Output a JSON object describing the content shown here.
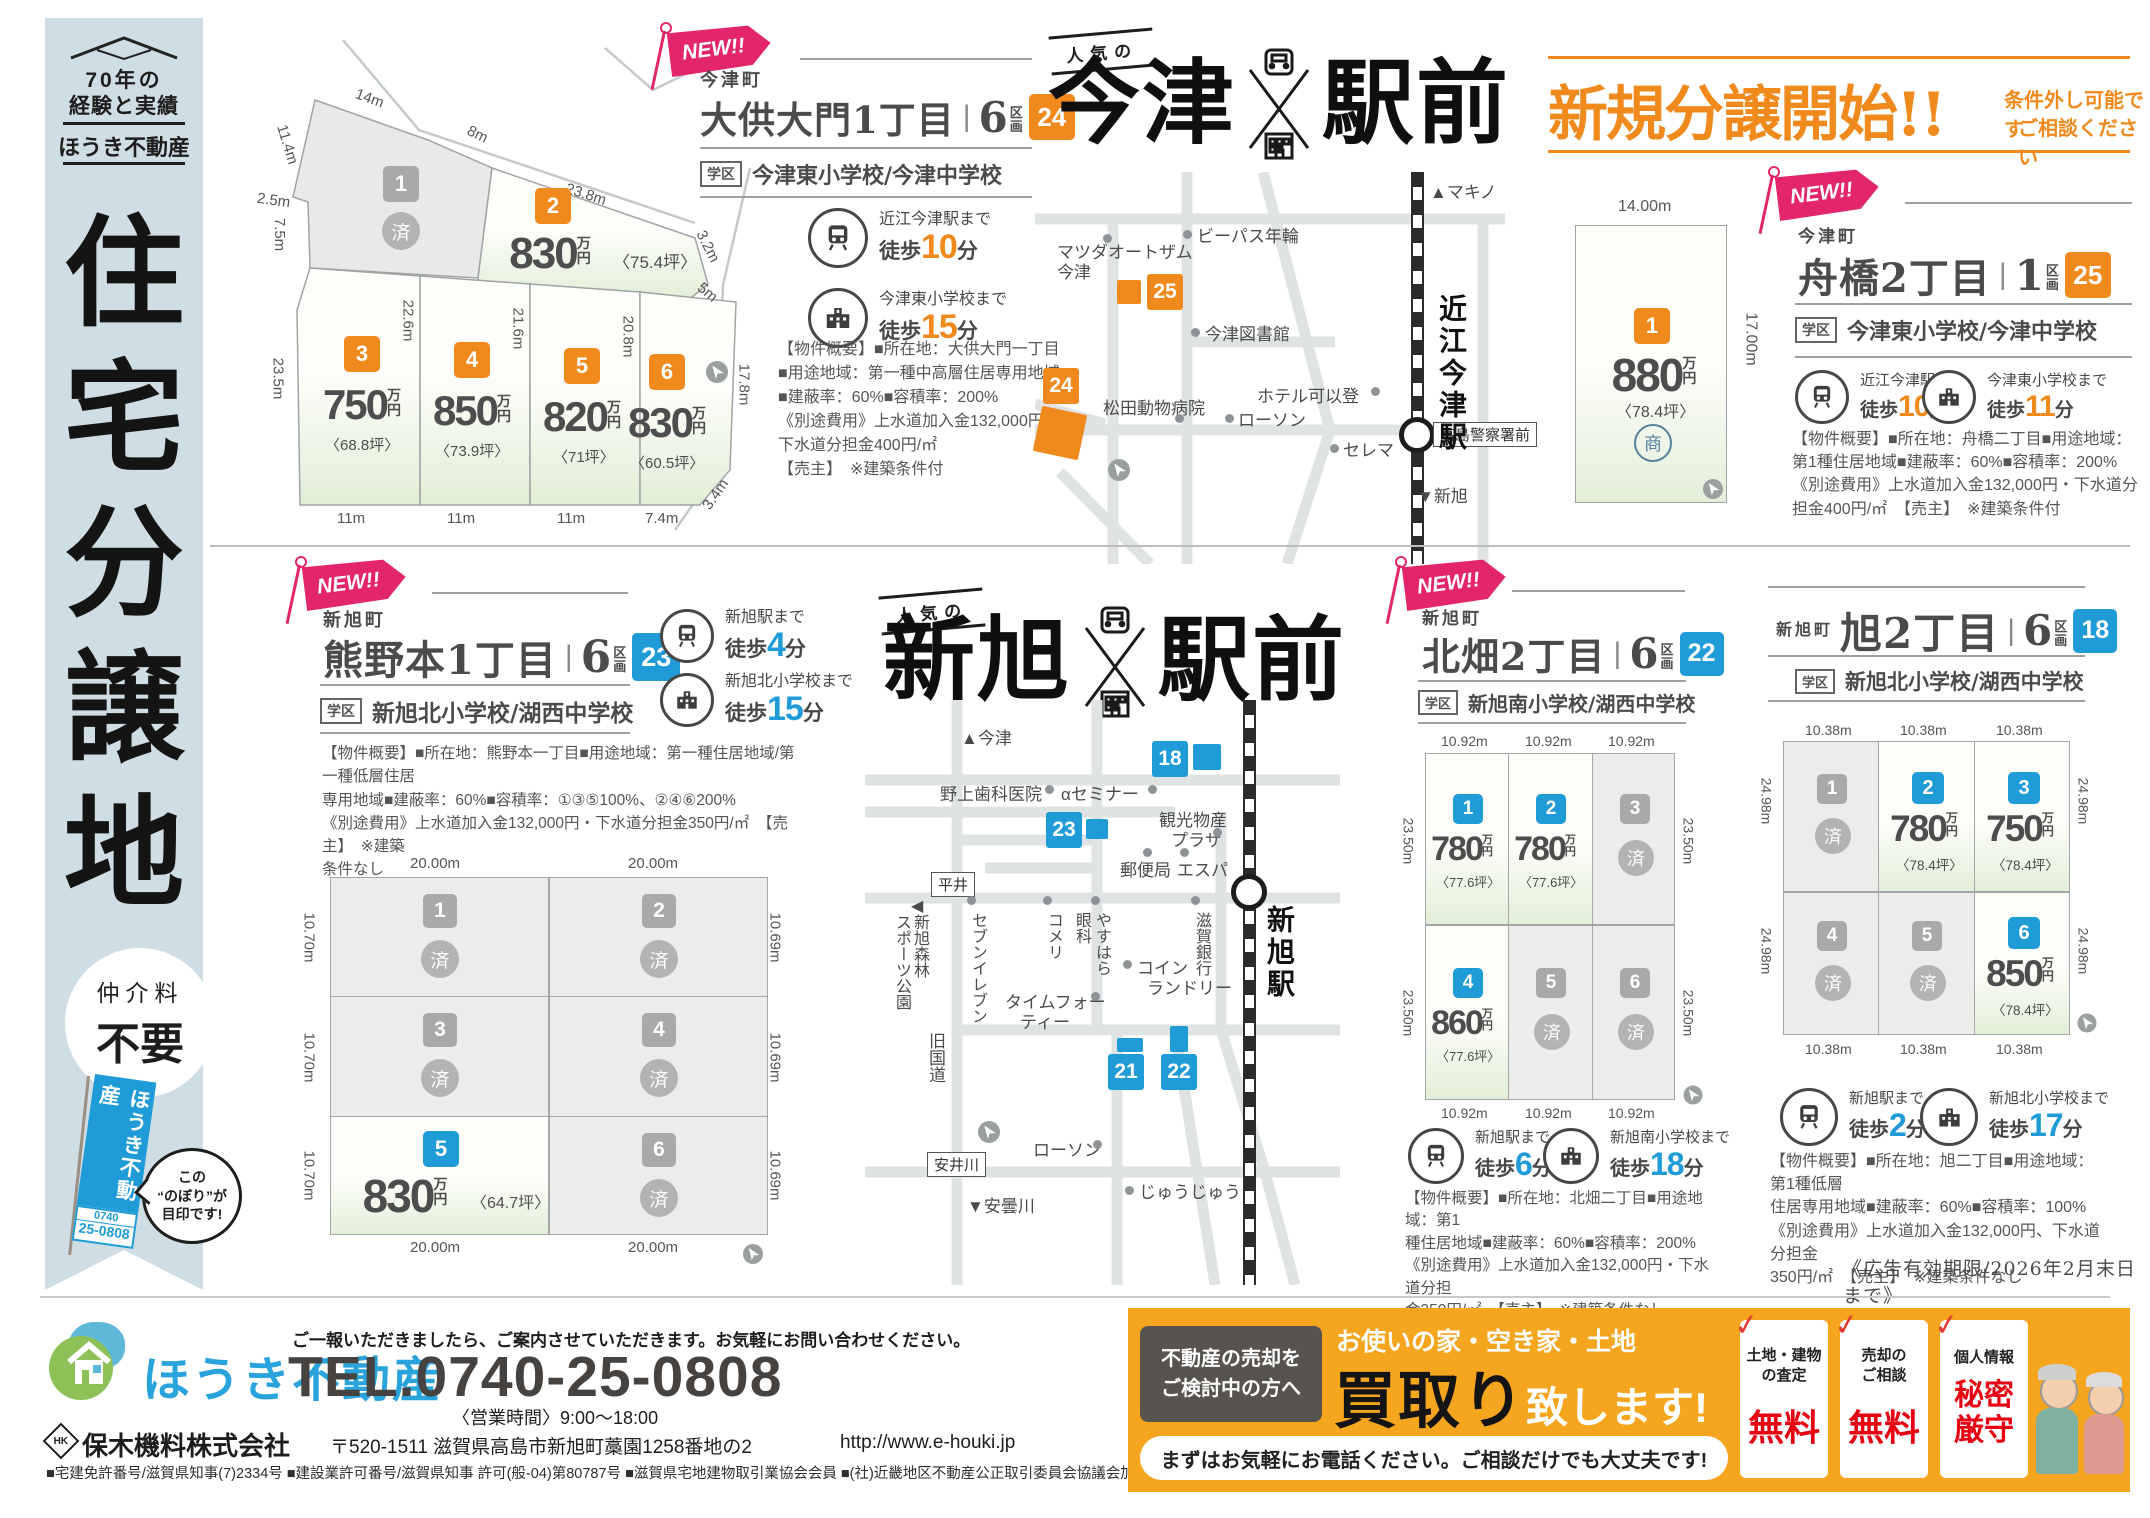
{
  "colors": {
    "orange": "#f08a1d",
    "blue": "#1f9cd8",
    "pink": "#e3256c",
    "footer_blue": "#29a3dc",
    "kaitori_orange": "#f6a51f",
    "check_red": "#e23a2e",
    "sidebar_bg": "#cfdde4"
  },
  "common": {
    "new": "NEW!!",
    "gakku": "学区",
    "sold": "済",
    "walk": "徒歩",
    "minute": "分",
    "man": "万",
    "yen": "円",
    "ku": "区",
    "kaku": "画",
    "popular": "人気の",
    "sho": "商"
  },
  "sidebar": {
    "roof_tag1": "70年の",
    "roof_tag2": "経験と実績",
    "brand": "ほうき不動産",
    "title_chars": [
      "住",
      "宅",
      "分",
      "譲",
      "地"
    ],
    "fee1": "仲介料",
    "fee2": "不要",
    "flag_text": "ほうき不動産",
    "flag_tel1": "0740",
    "flag_tel2": "25-0808",
    "bubble1": "この",
    "bubble2": "“のぼり”が",
    "bubble3": "目印です!"
  },
  "banner": {
    "title": "新規分譲開始!!",
    "note1": "条件外し可能です",
    "note2": "ご相談ください"
  },
  "titles": {
    "imazu_left": "今津",
    "imazu_right": "駅前",
    "shin_left": "新旭",
    "shin_right": "駅前"
  },
  "panels": {
    "odai": {
      "town": "今津町",
      "name": "大供大門1丁目",
      "lots": "6",
      "badge": "24",
      "school": "今津東小学校/今津中学校",
      "acc1_dest": "近江今津駅まで",
      "acc1_min": "10",
      "acc2_dest": "今津東小学校まで",
      "acc2_min": "15",
      "ov": [
        "【物件概要】■所在地：大供大門一丁目",
        "■用途地域：第一種中高層住居専用地域",
        "■建蔽率：60%■容積率：200%",
        "《別途費用》上水道加入金132,000円・",
        "下水道分担金400円/㎡",
        "【売主】　※建築条件付"
      ]
    },
    "funabashi": {
      "town": "今津町",
      "name": "舟橋2丁目",
      "lots": "1",
      "badge": "25",
      "school": "今津東小学校/今津中学校",
      "acc1_dest": "近江今津駅まで",
      "acc1_min": "10",
      "acc2_dest": "今津東小学校まで",
      "acc2_min": "11",
      "ov": [
        "【物件概要】■所在地：舟橋二丁目■用途地域：",
        "第1種住居地域■建蔽率：60%■容積率：200%",
        "《別途費用》上水道加入金132,000円・下水道分",
        "担金400円/㎡　【売主】　※建築条件付"
      ]
    },
    "kumano": {
      "town": "新旭町",
      "name": "熊野本1丁目",
      "lots": "6",
      "badge": "23",
      "school": "新旭北小学校/湖西中学校",
      "acc1_dest": "新旭駅まで",
      "acc1_min": "4",
      "acc2_dest": "新旭北小学校まで",
      "acc2_min": "15",
      "ov": [
        "【物件概要】■所在地：熊野本一丁目■用途地域：第一種住居地域/第一種低層住居",
        "専用地域■建蔽率：60%■容積率：①③⑤100%、②④⑥200%",
        "《別途費用》上水道加入金132,000円・下水道分担金350円/㎡　【売主】　※建築",
        "条件なし"
      ]
    },
    "kitabata": {
      "town": "新旭町",
      "name": "北畑2丁目",
      "lots": "6",
      "badge": "22",
      "school": "新旭南小学校/湖西中学校",
      "acc1_dest": "新旭駅まで",
      "acc1_min": "6",
      "acc2_dest": "新旭南小学校まで",
      "acc2_min": "18",
      "ov": [
        "【物件概要】■所在地：北畑二丁目■用途地域：第1",
        "種住居地域■建蔽率：60%■容積率：200%",
        "《別途費用》上水道加入金132,000円・下水道分担",
        "金350円/㎡　【売主】　※建築条件なし"
      ]
    },
    "asahi": {
      "town": "新旭町",
      "name": "旭2丁目",
      "lots": "6",
      "badge": "18",
      "school": "新旭北小学校/湖西中学校",
      "acc1_dest": "新旭駅まで",
      "acc1_min": "2",
      "acc2_dest": "新旭北小学校まで",
      "acc2_min": "17",
      "ov": [
        "【物件概要】■所在地：旭二丁目■用途地域：第1種低層",
        "住居専用地域■建蔽率：60%■容積率：100%",
        "《別途費用》上水道加入金132,000円、下水道分担金",
        "350円/㎡　【売主】　※建築条件なし"
      ],
      "expiry": "《広告有効期限/2026年2月末日まで》"
    }
  },
  "plot_odai": {
    "dims": {
      "d14": "14m",
      "d8": "8m",
      "d238": "23.8m",
      "d114": "11.4m",
      "d25": "2.5m",
      "d75": "7.5m",
      "d32": "3.2m",
      "d5": "5m",
      "d235": "23.5m",
      "d226": "22.6m",
      "d216": "21.6m",
      "d208": "20.8m",
      "d178": "17.8m",
      "d34": "3.4m",
      "d11a": "11m",
      "d11b": "11m",
      "d11c": "11m",
      "d74": "7.4m"
    },
    "lot1": {
      "num": "1"
    },
    "lot2": {
      "num": "2",
      "price": "830",
      "tsubo": "〈75.4坪〉"
    },
    "lot3": {
      "num": "3",
      "price": "750",
      "tsubo": "〈68.8坪〉"
    },
    "lot4": {
      "num": "4",
      "price": "850",
      "tsubo": "〈73.9坪〉"
    },
    "lot5": {
      "num": "5",
      "price": "820",
      "tsubo": "〈71坪〉"
    },
    "lot6": {
      "num": "6",
      "price": "830",
      "tsubo": "〈60.5坪〉"
    }
  },
  "plot_funabashi": {
    "top": "14.00m",
    "right": "17.00m",
    "num": "1",
    "price": "880",
    "tsubo": "〈78.4坪〉"
  },
  "grid_kumano": {
    "top": [
      "20.00m",
      "20.00m"
    ],
    "left": "10.70m",
    "right": "10.69m",
    "bottom": [
      "20.00m",
      "20.00m"
    ],
    "c1": {
      "num": "1"
    },
    "c2": {
      "num": "2"
    },
    "c3": {
      "num": "3"
    },
    "c4": {
      "num": "4"
    },
    "c5": {
      "num": "5",
      "price": "830",
      "tsubo": "〈64.7坪〉"
    },
    "c6": {
      "num": "6"
    }
  },
  "grid_kitabata": {
    "top": [
      "10.92m",
      "10.92m",
      "10.92m"
    ],
    "side": "23.50m",
    "bottom": [
      "10.92m",
      "10.92m",
      "10.92m"
    ],
    "c1": {
      "num": "1",
      "price": "780",
      "tsubo": "〈77.6坪〉"
    },
    "c2": {
      "num": "2",
      "price": "780",
      "tsubo": "〈77.6坪〉"
    },
    "c3": {
      "num": "3"
    },
    "c4": {
      "num": "4",
      "price": "860",
      "tsubo": "〈77.6坪〉"
    },
    "c5": {
      "num": "5"
    },
    "c6": {
      "num": "6"
    }
  },
  "grid_asahi": {
    "top": [
      "10.38m",
      "10.38m",
      "10.38m"
    ],
    "side": "24.98m",
    "bottom": [
      "10.38m",
      "10.38m",
      "10.38m"
    ],
    "c1": {
      "num": "1"
    },
    "c2": {
      "num": "2",
      "price": "780",
      "tsubo": "〈78.4坪〉"
    },
    "c3": {
      "num": "3",
      "price": "750",
      "tsubo": "〈78.4坪〉"
    },
    "c4": {
      "num": "4"
    },
    "c5": {
      "num": "5"
    },
    "c6": {
      "num": "6",
      "price": "850",
      "tsubo": "〈78.4坪〉"
    }
  },
  "map_imazu": {
    "makino": "▲マキノ",
    "bypass": "ビーパス年輪",
    "mazda1": "マツダオートザム",
    "mazda2": "今津",
    "m25": "25",
    "library": "今津図書館",
    "m24": "24",
    "matsuda": "松田動物病院",
    "lawson": "ローソン",
    "hotel": "ホテル可以登",
    "cerema": "セレマ",
    "police": "高島警察署前",
    "station": "近江今津駅",
    "shinasahi": "▼新旭"
  },
  "map_shin": {
    "imazu": "▲今津",
    "m18": "18",
    "dental": "野上歯科医院",
    "seminar": "αセミナー",
    "m23": "23",
    "kanko1": "観光物産",
    "kanko2": "プラザ",
    "post": "郵便局",
    "espa": "エスパ",
    "hirai": "平井",
    "park_arrow": "◀",
    "park1": "新旭森林",
    "park2": "スポーツ公園",
    "seven": "セブンイレブン",
    "komeri": "コメリ",
    "yasuhara": "やすはら",
    "ganka": "眼科",
    "bank": "滋賀銀行",
    "coin1": "コイン",
    "coin2": "ランドリー",
    "time1": "タイムフォー",
    "time2": "ティー",
    "kyu": "旧国道",
    "m21": "21",
    "m22": "22",
    "lawson": "ローソン",
    "yasui": "安井川",
    "juju": "じゅうじゅう",
    "ado": "▼安曇川",
    "station": "新旭駅"
  },
  "footer": {
    "brand": "ほうき不動産",
    "message": "ご一報いただきましたら、ご案内させていただきます。お気軽にお問い合わせください。",
    "tel": "TEL.0740-25-0808",
    "hours": "〈営業時間〉9:00〜18:00",
    "hk": "HK",
    "company": "保木機料株式会社",
    "address": "〒520-1511 滋賀県高島市新旭町藁園1258番地の2",
    "url": "http://www.e-houki.jp",
    "licenses": "■宅建免許番号/滋賀県知事(7)2334号 ■建設業許可番号/滋賀県知事 許可(般-04)第80787号 ■滋賀県宅地建物取引業協会会員 ■(社)近畿地区不動産公正取引委員会協議会加盟",
    "kaitori": {
      "lead1": "不動産の売却を",
      "lead2": "ご検討中の方へ",
      "head": "お使いの家・空き家・土地",
      "big1": "買取り",
      "big2": "致します!",
      "foot": "まずはお気軽にお電話ください。ご相談だけでも大丈夫です!",
      "check": "✓",
      "card1a": "土地・建物",
      "card1b": "の査定",
      "card1c": "無料",
      "card2a": "売却の",
      "card2b": "ご相談",
      "card2c": "無料",
      "card3a": "個人情報",
      "card3b": "秘密",
      "card3c": "厳守"
    }
  }
}
